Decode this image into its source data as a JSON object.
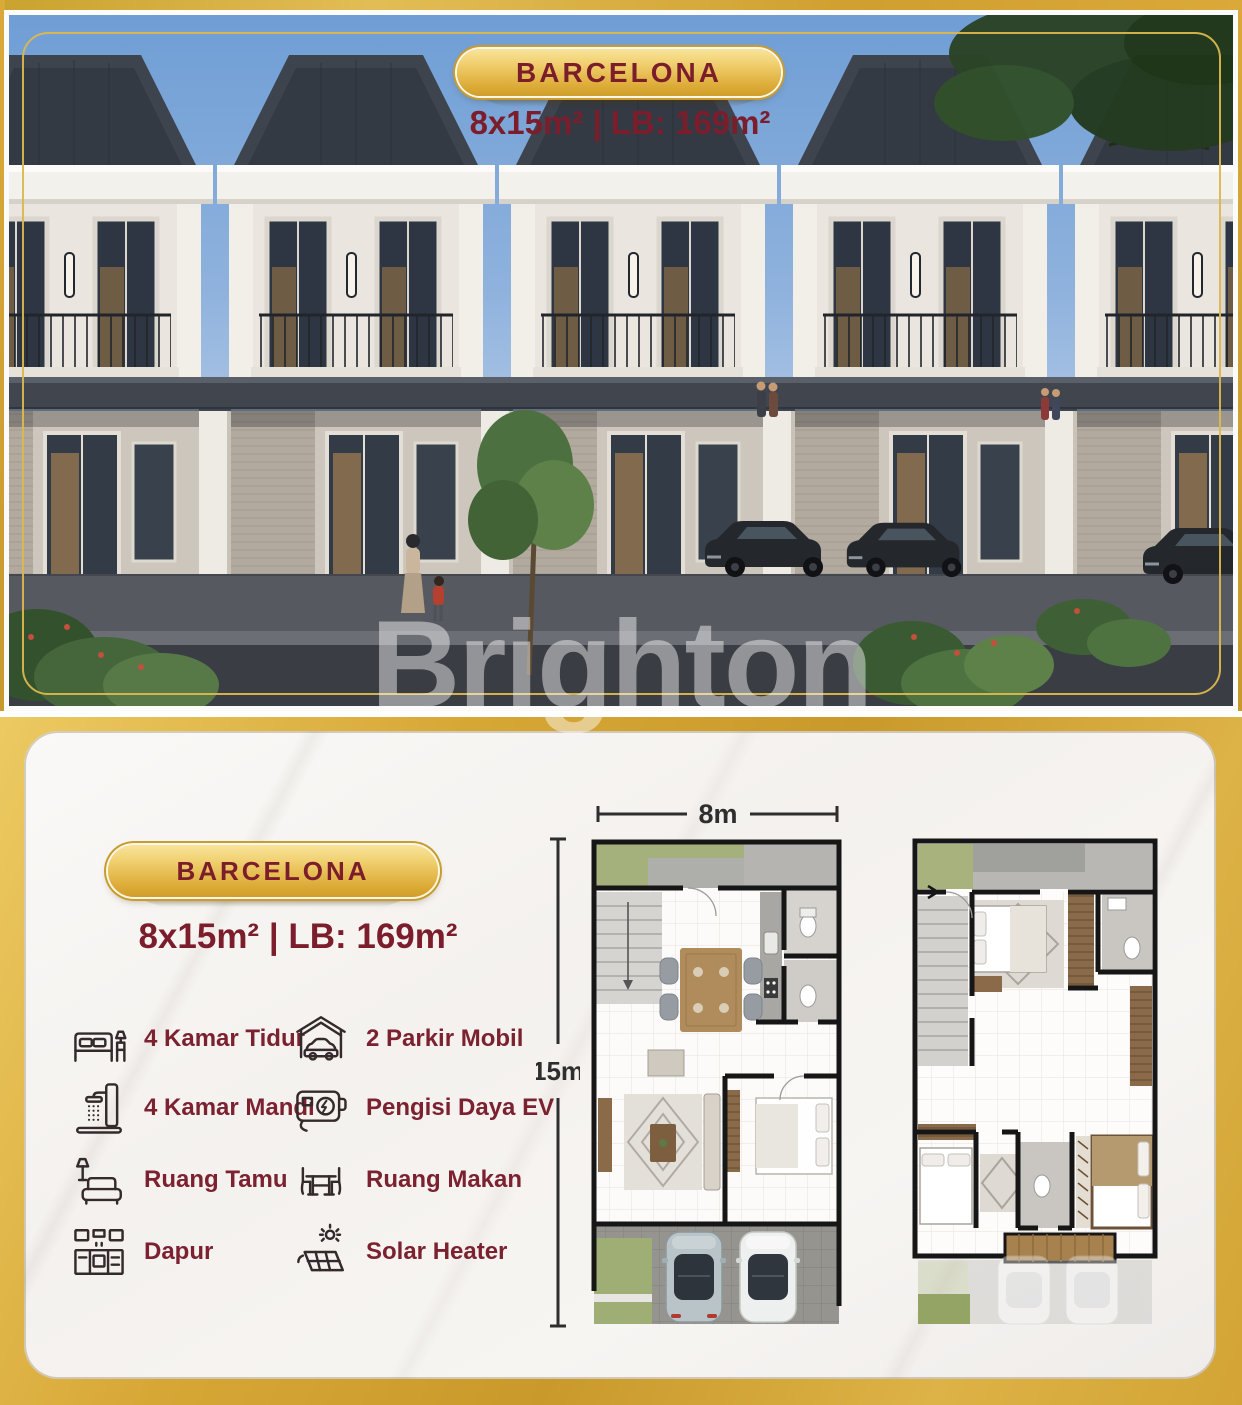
{
  "brand": {
    "watermark": "Brighton"
  },
  "hero": {
    "badge": "BARCELONA",
    "spec": "8x15m² | LB: 169m²"
  },
  "details": {
    "badge": "BARCELONA",
    "spec": "8x15m² | LB: 169m²",
    "features_left": [
      {
        "icon": "bed-icon",
        "label": "4 Kamar Tidur"
      },
      {
        "icon": "shower-icon",
        "label": "4 Kamar Mandi"
      },
      {
        "icon": "sofa-icon",
        "label": "Ruang Tamu"
      },
      {
        "icon": "kitchen-icon",
        "label": "Dapur"
      }
    ],
    "features_right": [
      {
        "icon": "carport-icon",
        "label": "2 Parkir Mobil"
      },
      {
        "icon": "ev-charger-icon",
        "label": "Pengisi Daya EV"
      },
      {
        "icon": "dining-icon",
        "label": "Ruang Makan"
      },
      {
        "icon": "solar-icon",
        "label": "Solar Heater"
      }
    ],
    "floorplan": {
      "width_label": "8m",
      "height_label": "15m"
    }
  },
  "colors": {
    "gold": "#d5a534",
    "gold_light": "#f0cf6e",
    "maroon": "#7b1d2b",
    "sky": "#7fa3d4",
    "card": "#f6f4f1",
    "roof": "#3a404a",
    "lawn": "#a5b17c"
  }
}
